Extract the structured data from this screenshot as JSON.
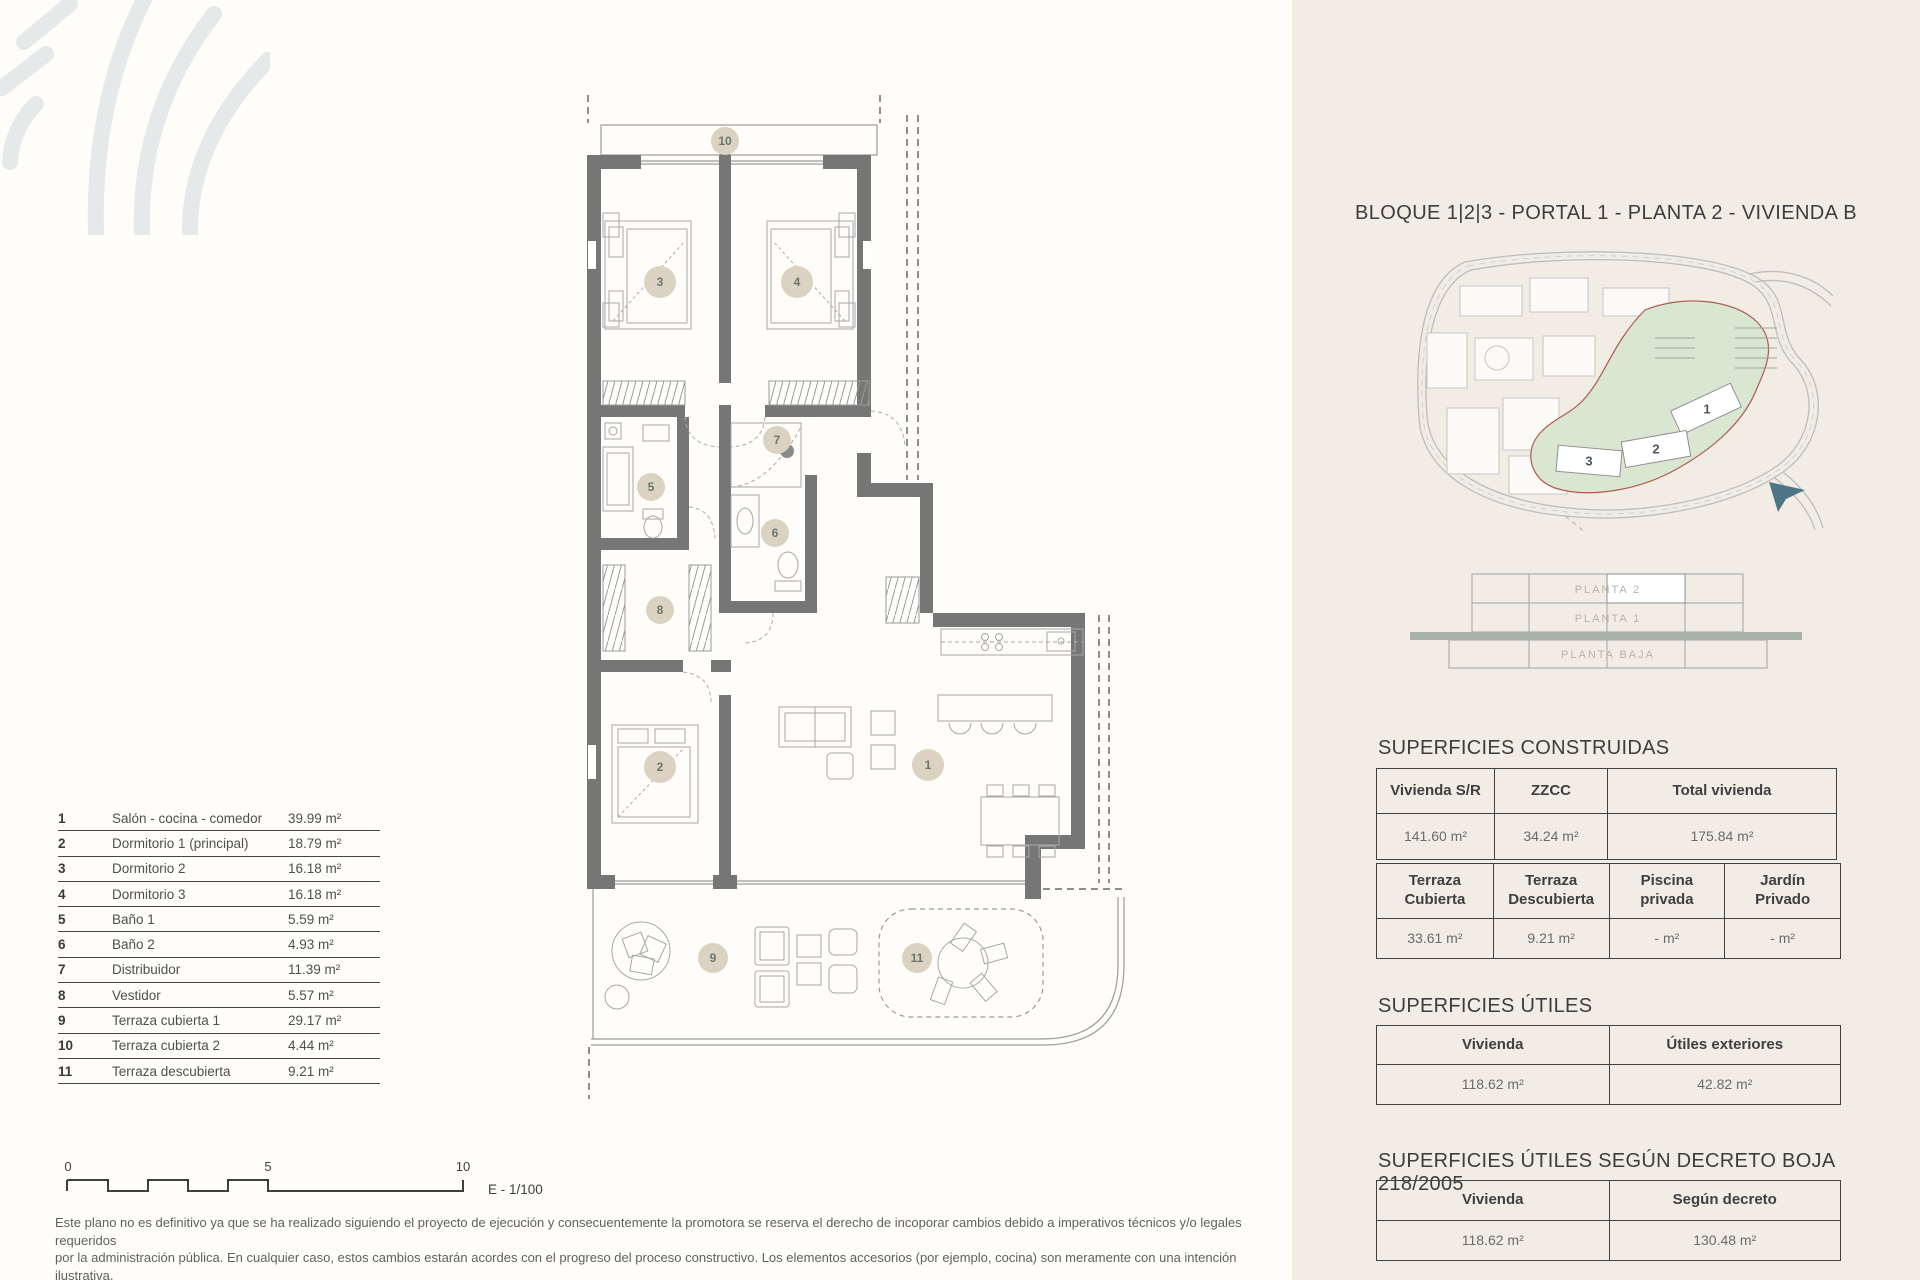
{
  "plan": {
    "rooms": [
      "1",
      "2",
      "3",
      "4",
      "5",
      "6",
      "7",
      "8",
      "9",
      "10",
      "11"
    ]
  },
  "legend": {
    "rows": [
      {
        "num": "1",
        "name": "Salón - cocina - comedor",
        "area": "39.99 m²"
      },
      {
        "num": "2",
        "name": "Dormitorio 1 (principal)",
        "area": "18.79 m²"
      },
      {
        "num": "3",
        "name": "Dormitorio 2",
        "area": "16.18 m²"
      },
      {
        "num": "4",
        "name": "Dormitorio 3",
        "area": "16.18 m²"
      },
      {
        "num": "5",
        "name": "Baño 1",
        "area": "5.59 m²"
      },
      {
        "num": "6",
        "name": "Baño 2",
        "area": "4.93 m²"
      },
      {
        "num": "7",
        "name": "Distribuidor",
        "area": "11.39 m²"
      },
      {
        "num": "8",
        "name": "Vestidor",
        "area": "5.57 m²"
      },
      {
        "num": "9",
        "name": "Terraza cubierta 1",
        "area": "29.17 m²"
      },
      {
        "num": "10",
        "name": "Terraza cubierta 2",
        "area": "4.44 m²"
      },
      {
        "num": "11",
        "name": "Terraza descubierta",
        "area": "9.21 m²"
      }
    ]
  },
  "scalebar": {
    "tick0": "0",
    "tick5": "5",
    "tick10": "10",
    "scale_label": "E - 1/100"
  },
  "disclaimer": {
    "line1": "Este plano no es definitivo ya que se ha realizado siguiendo el proyecto de ejecución y consecuentemente la promotora se reserva el derecho de incoporar cambios debido a imperativos técnicos y/o legales requeridos",
    "line2": "por la administración pública. En cualquier caso, estos cambios estarán acordes con el progreso del proceso constructivo. Los elementos accesorios (por ejemplo, cocina) son meramente con una intención ilustrativa.",
    "line3": "Las superficies mostradas son siempre aproximadas y puedes verse alteradas por motivos técnicos o legales a lo largo del proceso de construcción."
  },
  "panel": {
    "title": "BLOQUE 1|2|3 - PORTAL 1 - PLANTA 2 - VIVIENDA B",
    "siteplan": {
      "labels": [
        "1",
        "2",
        "3"
      ]
    },
    "stack": {
      "levels": [
        "PLANTA 2",
        "PLANTA 1",
        "PLANTA BAJA"
      ]
    },
    "construidas": {
      "heading": "SUPERFICIES CONSTRUIDAS",
      "t1_headers": [
        "Vivienda S/R",
        "ZZCC",
        "Total vivienda"
      ],
      "t1_values": [
        "141.60 m²",
        "34.24 m²",
        "175.84 m²"
      ],
      "t2_headers": [
        "Terraza Cubierta",
        "Terraza Descubierta",
        "Piscina privada",
        "Jardín Privado"
      ],
      "t2_values": [
        "33.61 m²",
        "9.21 m²",
        "- m²",
        "- m²"
      ]
    },
    "utiles": {
      "heading": "SUPERFICIES ÚTILES",
      "headers": [
        "Vivienda",
        "Útiles exteriores"
      ],
      "values": [
        "118.62 m²",
        "42.82 m²"
      ]
    },
    "decreto": {
      "heading": "SUPERFICIES ÚTILES SEGÚN DECRETO BOJA 218/2005",
      "headers": [
        "Vivienda",
        "Según decreto"
      ],
      "values": [
        "118.62 m²",
        "130.48 m²"
      ]
    }
  }
}
